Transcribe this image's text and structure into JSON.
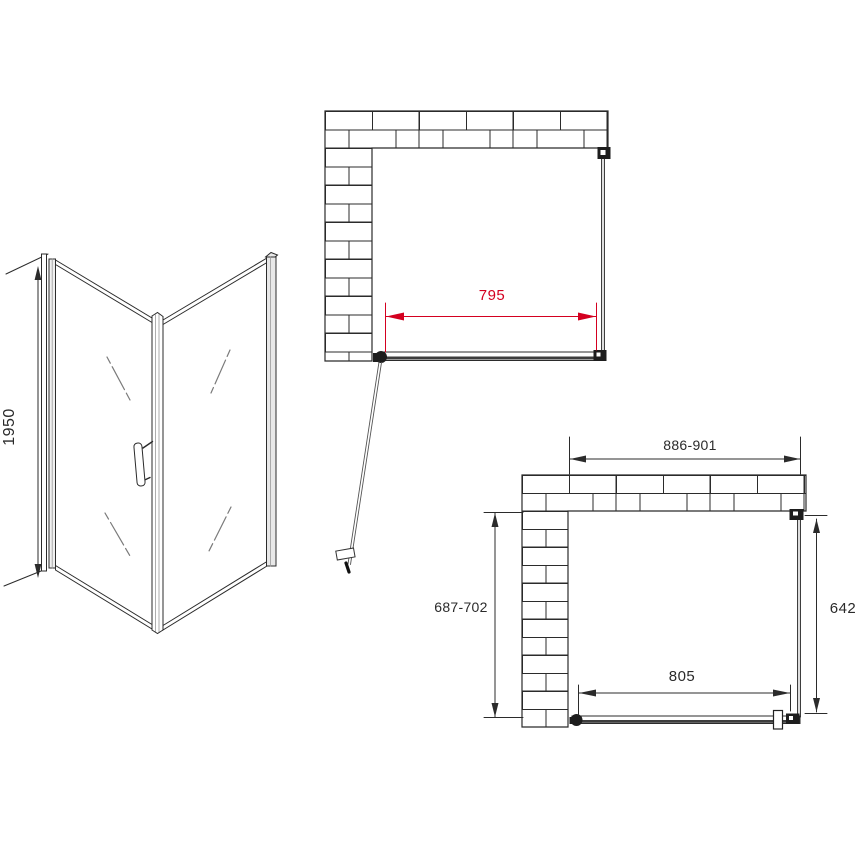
{
  "drawing": {
    "perspective_view": {
      "height": "1950"
    },
    "plan_top_view": {
      "glass_width": "795"
    },
    "plan_bottom_view": {
      "overall_width_range": "886-901",
      "side_depth_range": "687-702",
      "side_panel_width": "642",
      "bottom_glass_width": "805"
    },
    "colors": {
      "line": "#2b2b2b",
      "red_dimension": "#d40020",
      "glass_shade": "#dddddd"
    }
  }
}
